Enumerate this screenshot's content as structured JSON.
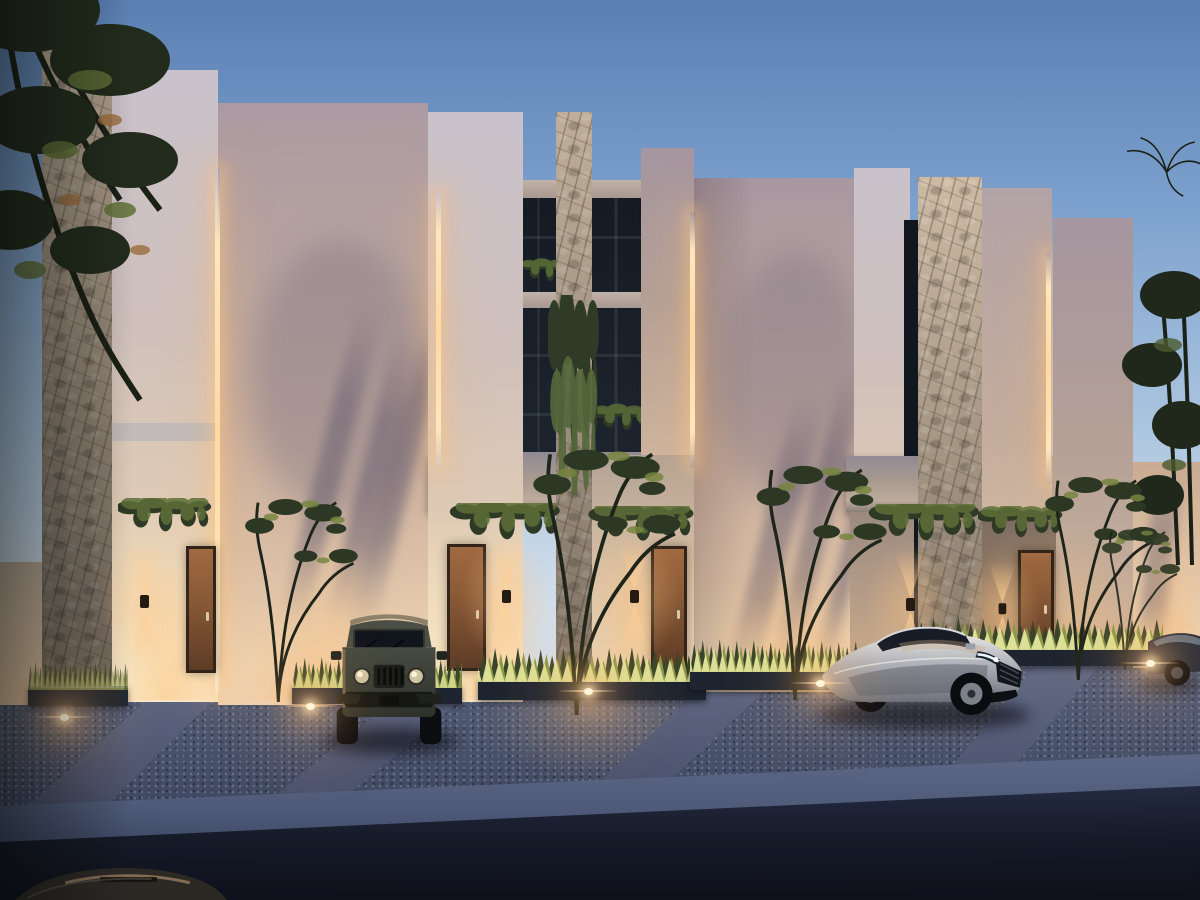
{
  "scene": {
    "title": "Twilight exterior rendering of a row of modern minimalist townhouses with stone-clad columns, warm LED accent lighting, landscaped gravel parking pads, a dark SUV and a silver fastback sedan parked out front",
    "time_of_day": "dusk",
    "objects": [
      {
        "name": "sky",
        "desc": "clear dusk sky, blue fading to pale horizon"
      },
      {
        "name": "townhouse-row",
        "desc": "tall stucco slab facades of varying heights"
      },
      {
        "name": "stone-columns",
        "count": 3,
        "desc": "rough stone-clad vertical piers"
      },
      {
        "name": "led-strips",
        "count": 4,
        "desc": "warm vertical cove lighting between slabs"
      },
      {
        "name": "entry-doors",
        "count": 4,
        "material": "wood"
      },
      {
        "name": "wall-sconces",
        "count": 5,
        "type": "up-down cone lights"
      },
      {
        "name": "balcony-bands",
        "count": 3,
        "desc": "concrete overhangs with hanging ivy"
      },
      {
        "name": "suv",
        "desc": "dark olive boxy SUV parked front-facing"
      },
      {
        "name": "sedan",
        "desc": "silver fastback sedan parked at an angle"
      },
      {
        "name": "partial-car-right",
        "desc": "dark car at right edge of frame"
      },
      {
        "name": "partial-car-corner",
        "desc": "car roof entering bottom-left corner"
      },
      {
        "name": "planters",
        "desc": "uplit ornamental grasses along facade"
      },
      {
        "name": "yard-trees",
        "count": 5,
        "desc": "young multi-trunk trees"
      },
      {
        "name": "gravel-pads",
        "desc": "blue-grey gravel parking pads with ground spotlights"
      },
      {
        "name": "street",
        "desc": "dark asphalt street across foreground"
      }
    ],
    "palette": {
      "sky_top": "#5a7fb2",
      "sky_mid": "#7fa3cf",
      "sky_low": "#aec7e0",
      "sky_horizon": "#d2deea",
      "wall_warm": "#e9d0b0",
      "wall_mid": "#c6ad9f",
      "wall_shadow": "#a3939f",
      "stone_light": "#bfae99",
      "stone_dark": "#7c7164",
      "window_glass": "#141a22",
      "door_wood": "#8a5a36",
      "led_glow": "#ffd9a2",
      "grass_lit": "#d9dc8e",
      "foliage_dark": "#273020",
      "gravel": "#4c566f",
      "concrete_walk": "#68708a",
      "curb": "#4e5a78",
      "street": "#161b29",
      "car_silver": "#b9bdc6",
      "car_dark": "#3b3e37"
    }
  }
}
